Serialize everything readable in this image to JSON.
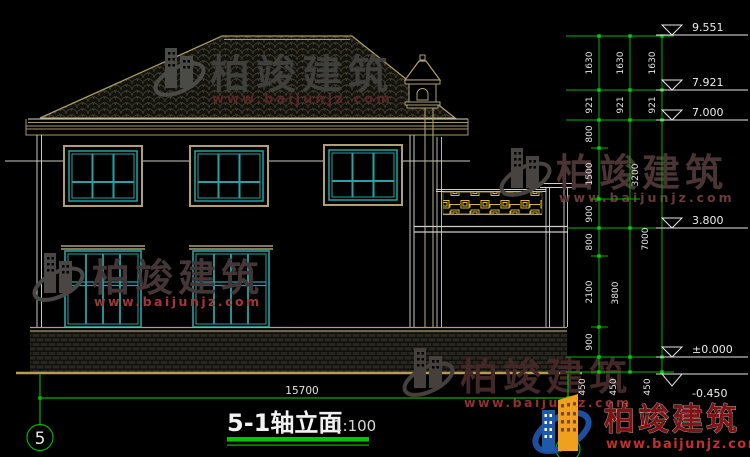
{
  "drawing": {
    "title": "5-1轴立面",
    "scale": "1:100",
    "axis_left_label": "5",
    "bottom_dim": "15700"
  },
  "elevations": {
    "ridge": "9.551",
    "roof_mid": "7.921",
    "eave": "7.000",
    "gate_wall": "3.800",
    "floor": "±0.000",
    "ground": "-0.450"
  },
  "dims": {
    "inner": [
      "1630",
      "921",
      "800",
      "1500",
      "900",
      "800",
      "2100",
      "900",
      "450"
    ],
    "middle": [
      "1630",
      "921",
      "3200",
      "3800",
      "450"
    ],
    "outer": [
      "1630",
      "921",
      "7000",
      "450"
    ]
  },
  "watermark": {
    "brand": "柏竣建筑",
    "url": "www.baijunjz.com"
  },
  "colors": {
    "dim_green": "#00b400",
    "frame_tan": "#a89868",
    "window_cyan": "#22a4a4",
    "brand_red": "#801212",
    "url_red": "#c22f2f"
  }
}
